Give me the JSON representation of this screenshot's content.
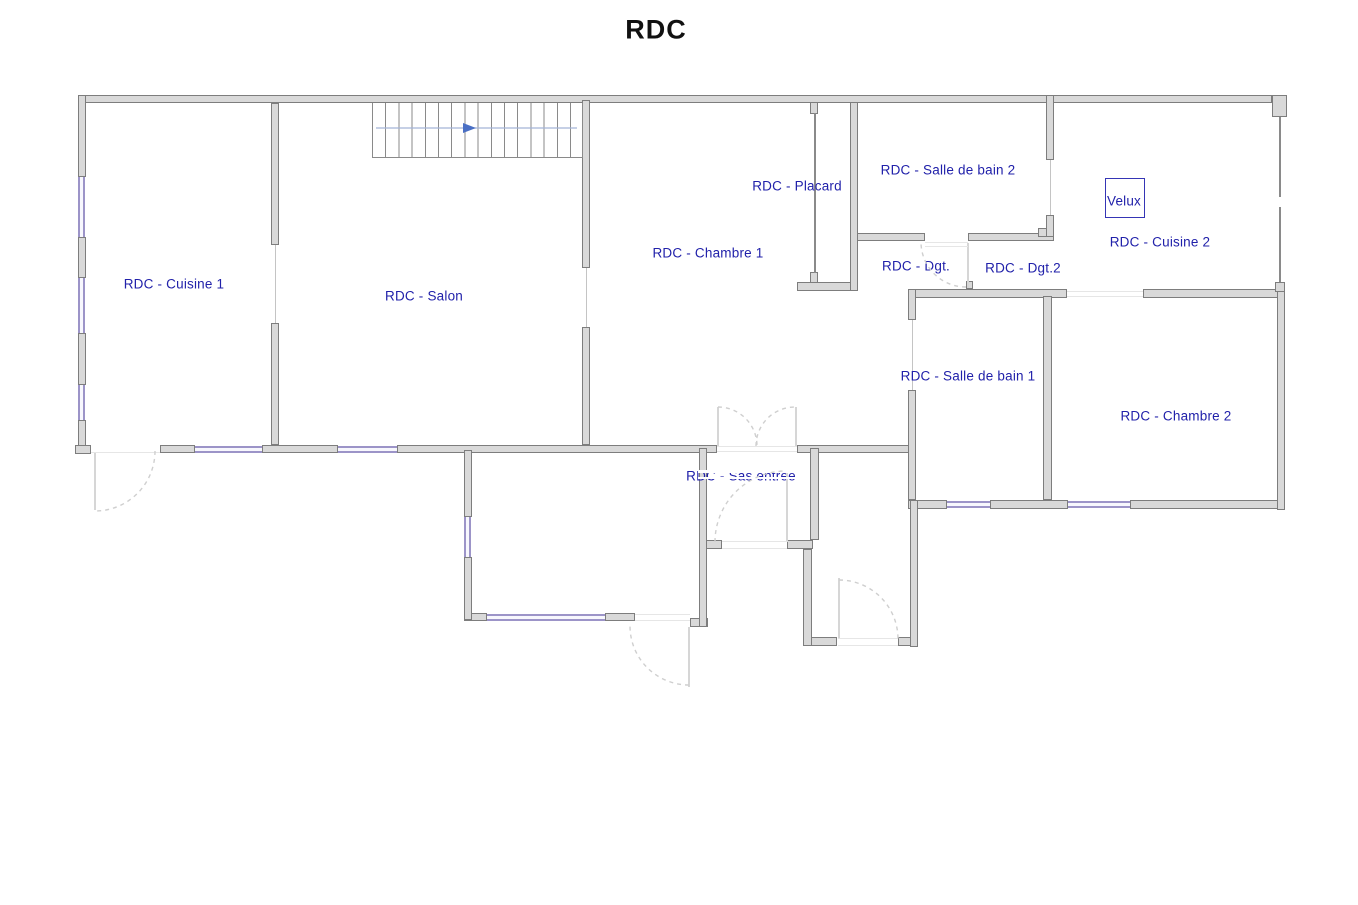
{
  "title": {
    "text": "RDC",
    "x": 656,
    "y": 30
  },
  "colors": {
    "wall_fill": "#d9d9d9",
    "wall_edge": "#7d7d7d",
    "window": "#9c94c8",
    "window_fill": "#f7f7fd",
    "label_text": "#2121aa",
    "title_text": "#111111",
    "arc": "#cfcfcf",
    "partition": "#8a8a8a",
    "door_line": "#c4c4c4",
    "leaf": "#d6d6d6",
    "threshold": "#e6e6e6",
    "stair_line": "#a3b3d6",
    "stair_arrow": "#4a6fc4",
    "velux_border": "#3535b5"
  },
  "rooms": [
    {
      "id": "cuisine-1",
      "label": "RDC - Cuisine 1",
      "x": 174,
      "y": 284
    },
    {
      "id": "salon",
      "label": "RDC - Salon",
      "x": 424,
      "y": 296
    },
    {
      "id": "chambre-1",
      "label": "RDC - Chambre 1",
      "x": 708,
      "y": 253
    },
    {
      "id": "placard",
      "label": "RDC - Placard",
      "x": 797,
      "y": 186
    },
    {
      "id": "salle-de-bain-2",
      "label": "RDC - Salle de bain 2",
      "x": 948,
      "y": 170
    },
    {
      "id": "dgt",
      "label": "RDC - Dgt.",
      "x": 916,
      "y": 266
    },
    {
      "id": "dgt-2",
      "label": "RDC - Dgt.2",
      "x": 1023,
      "y": 268
    },
    {
      "id": "cuisine-2",
      "label": "RDC - Cuisine 2",
      "x": 1160,
      "y": 242
    },
    {
      "id": "salle-de-bain-1",
      "label": "RDC - Salle de bain 1",
      "x": 968,
      "y": 376
    },
    {
      "id": "chambre-2",
      "label": "RDC - Chambre 2",
      "x": 1176,
      "y": 416
    },
    {
      "id": "sas-entree",
      "label": "RDC - Sas entrée",
      "x": 741,
      "y": 476
    }
  ],
  "velux": {
    "label": "Velux",
    "box": [
      1105,
      178,
      40,
      40
    ],
    "label_x": 1124,
    "label_y": 201
  },
  "geometry": {
    "walls": [
      [
        78,
        95,
        1194,
        8
      ],
      [
        1272,
        95,
        15,
        22
      ],
      [
        160,
        445,
        35,
        8
      ],
      [
        262,
        445,
        76,
        8
      ],
      [
        397,
        445,
        320,
        8
      ],
      [
        797,
        445,
        119,
        8
      ],
      [
        850,
        233,
        75,
        8
      ],
      [
        968,
        233,
        86,
        8
      ],
      [
        797,
        282,
        61,
        9
      ],
      [
        908,
        289,
        159,
        9
      ],
      [
        966,
        281,
        7,
        8
      ],
      [
        1143,
        289,
        142,
        9
      ],
      [
        1038,
        228,
        16,
        9
      ],
      [
        908,
        500,
        39,
        9
      ],
      [
        990,
        500,
        78,
        9
      ],
      [
        1130,
        500,
        155,
        9
      ],
      [
        464,
        613,
        23,
        8
      ],
      [
        605,
        613,
        30,
        8
      ],
      [
        699,
        540,
        23,
        9
      ],
      [
        787,
        540,
        26,
        9
      ],
      [
        690,
        618,
        18,
        9
      ],
      [
        803,
        637,
        34,
        9
      ],
      [
        898,
        637,
        20,
        9
      ],
      [
        78,
        95,
        8,
        82
      ],
      [
        78,
        237,
        8,
        41
      ],
      [
        78,
        333,
        8,
        52
      ],
      [
        78,
        420,
        8,
        33
      ],
      [
        75,
        445,
        16,
        9
      ],
      [
        271,
        103,
        8,
        142
      ],
      [
        271,
        323,
        8,
        122
      ],
      [
        582,
        100,
        8,
        168
      ],
      [
        582,
        327,
        8,
        118
      ],
      [
        850,
        102,
        8,
        189
      ],
      [
        1046,
        95,
        8,
        65
      ],
      [
        1046,
        215,
        8,
        22
      ],
      [
        1277,
        289,
        8,
        221
      ],
      [
        1275,
        282,
        10,
        10
      ],
      [
        1043,
        296,
        9,
        204
      ],
      [
        908,
        289,
        8,
        31
      ],
      [
        908,
        390,
        8,
        110
      ],
      [
        910,
        500,
        8,
        147
      ],
      [
        699,
        448,
        8,
        179
      ],
      [
        810,
        448,
        9,
        92
      ],
      [
        803,
        549,
        9,
        97
      ],
      [
        464,
        450,
        8,
        67
      ],
      [
        464,
        557,
        8,
        63
      ],
      [
        810,
        102,
        8,
        12
      ],
      [
        810,
        272,
        8,
        11
      ]
    ],
    "windows": [
      [
        195,
        446,
        67,
        "h"
      ],
      [
        338,
        446,
        59,
        "h"
      ],
      [
        947,
        501,
        43,
        "h"
      ],
      [
        1068,
        501,
        62,
        "h"
      ],
      [
        487,
        614,
        118,
        "h"
      ],
      [
        78,
        177,
        60,
        "v"
      ],
      [
        78,
        278,
        55,
        "v"
      ],
      [
        78,
        385,
        35,
        "v"
      ],
      [
        464,
        517,
        40,
        "v"
      ]
    ],
    "partitions": [
      [
        814,
        113,
        2,
        160
      ],
      [
        372,
        103,
        1,
        55
      ],
      [
        372,
        157,
        211,
        1
      ],
      [
        1279,
        117,
        2,
        80
      ],
      [
        1279,
        207,
        2,
        75
      ]
    ],
    "door_lines": [
      [
        275,
        245,
        1,
        78
      ],
      [
        586,
        268,
        1,
        59
      ],
      [
        1050,
        160,
        1,
        55
      ],
      [
        912,
        320,
        1,
        70
      ]
    ],
    "leaves": [
      [
        94,
        453,
        2,
        57
      ],
      [
        967,
        243,
        2,
        45
      ],
      [
        717,
        407,
        2,
        40
      ],
      [
        795,
        407,
        2,
        40
      ],
      [
        688,
        627,
        2,
        60
      ],
      [
        838,
        578,
        2,
        60
      ],
      [
        786,
        471,
        2,
        71
      ]
    ],
    "thresholds": [
      [
        91,
        452,
        69,
        1
      ],
      [
        717,
        446,
        80,
        1
      ],
      [
        717,
        451,
        80,
        1
      ],
      [
        925,
        242,
        43,
        1
      ],
      [
        925,
        246,
        43,
        1
      ],
      [
        722,
        541,
        65,
        1
      ],
      [
        722,
        548,
        65,
        1
      ],
      [
        1067,
        291,
        76,
        1
      ],
      [
        1067,
        296,
        76,
        1
      ],
      [
        838,
        638,
        60,
        1
      ],
      [
        838,
        645,
        60,
        1
      ],
      [
        635,
        614,
        55,
        1
      ],
      [
        635,
        620,
        55,
        1
      ]
    ],
    "white_overlays": [
      [
        698,
        470,
        104,
        3
      ],
      [
        698,
        477,
        104,
        2
      ]
    ],
    "arcs": [
      [
        95,
        451,
        60,
        0,
        90
      ],
      [
        966,
        242,
        45,
        90,
        180
      ],
      [
        786,
        542,
        71,
        180,
        270
      ],
      [
        718,
        446,
        39,
        270,
        360
      ],
      [
        795,
        446,
        39,
        180,
        270
      ],
      [
        689,
        626,
        59,
        90,
        180
      ],
      [
        839,
        639,
        59,
        270,
        360
      ]
    ],
    "stairs": {
      "x": 372,
      "y": 103,
      "w": 211,
      "h": 55,
      "arrow": {
        "y": 128,
        "x1": 376,
        "x2": 577,
        "head_x": 463,
        "head_w": 13,
        "head_h": 10
      }
    }
  }
}
